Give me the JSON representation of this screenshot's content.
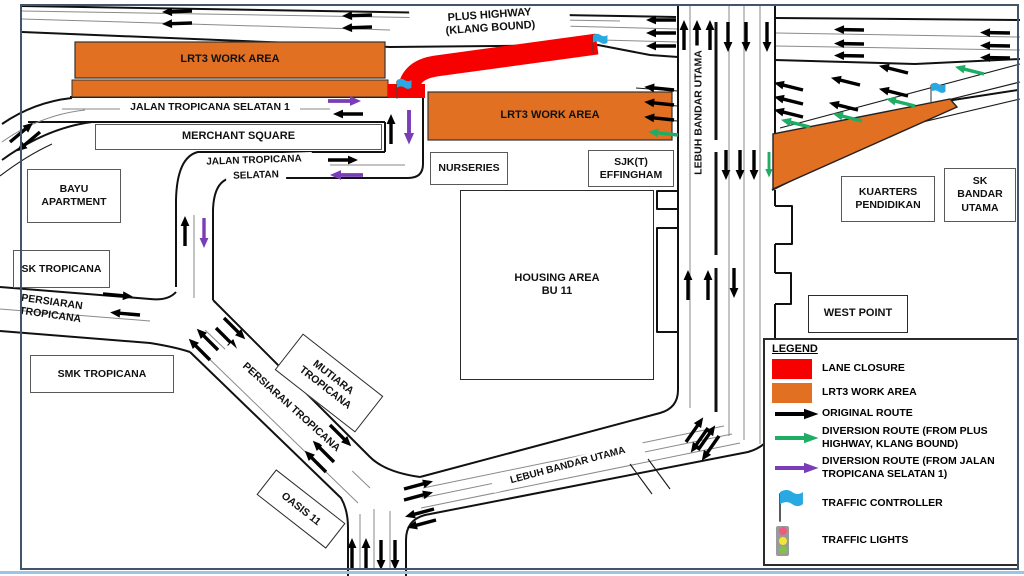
{
  "colors": {
    "lane_closure_red": "#F70000",
    "work_area_orange": "#E17023",
    "original_route_black": "#000000",
    "diversion_green": "#1FAD66",
    "diversion_purple": "#7A3DB8",
    "traffic_controller_blue": "#29A9E1",
    "traffic_light_red": "#ED5C7E",
    "traffic_light_yellow": "#F2E636",
    "traffic_light_green": "#85C04D",
    "frame_border": "#44546A",
    "frame_accent": "#9DC3E6"
  },
  "labels": {
    "plus_highway_1": "PLUS HIGHWAY",
    "plus_highway_2": "(KLANG BOUND)",
    "lrt3_work_area_left": "LRT3 WORK AREA",
    "lrt3_work_area_mid": "LRT3 WORK AREA",
    "jalan_tropicana_selatan_1": "JALAN TROPICANA SELATAN 1",
    "merchant_square": "MERCHANT SQUARE",
    "jalan_tropicana": "JALAN TROPICANA",
    "selatan": "SELATAN",
    "bayu_apartment": "BAYU APARTMENT",
    "sk_tropicana": "SK TROPICANA",
    "persiaran_tropicana_w_1": "PERSIARAN",
    "persiaran_tropicana_w_2": "TROPICANA",
    "smk_tropicana": "SMK TROPICANA",
    "nurseries": "NURSERIES",
    "sjkt_effingham_1": "SJK(T)",
    "sjkt_effingham_2": "EFFINGHAM",
    "housing_area_1": "HOUSING AREA",
    "housing_area_2": "BU 11",
    "lebuh_bandar_utama_vertical": "LEBUH BANDAR UTAMA",
    "kuarters_pendidikan_1": "KUARTERS",
    "kuarters_pendidikan_2": "PENDIDIKAN",
    "sk_bandar_utama_1": "SK",
    "sk_bandar_utama_2": "BANDAR",
    "sk_bandar_utama_3": "UTAMA",
    "west_point": "WEST POINT",
    "mutiara_tropicana_1": "MUTIARA",
    "mutiara_tropicana_2": "TROPICANA",
    "persiaran_tropicana_diag": "PERSIARAN TROPICANA",
    "oasis_11": "OASIS 11",
    "lebuh_bandar_utama_bottom": "LEBUH BANDAR UTAMA"
  },
  "legend": {
    "title": "LEGEND",
    "items": [
      {
        "icon": "red-swatch",
        "label": "LANE CLOSURE"
      },
      {
        "icon": "orange-swatch",
        "label": "LRT3 WORK AREA"
      },
      {
        "icon": "black-arrow",
        "label": "ORIGINAL ROUTE"
      },
      {
        "icon": "green-arrow",
        "label": "DIVERSION ROUTE (FROM PLUS HIGHWAY, KLANG BOUND)"
      },
      {
        "icon": "purple-arrow",
        "label": "DIVERSION ROUTE (FROM JALAN TROPICANA SELATAN 1)"
      },
      {
        "icon": "blue-flag",
        "label": "TRAFFIC CONTROLLER"
      },
      {
        "icon": "traffic-light",
        "label": "TRAFFIC LIGHTS"
      }
    ]
  }
}
